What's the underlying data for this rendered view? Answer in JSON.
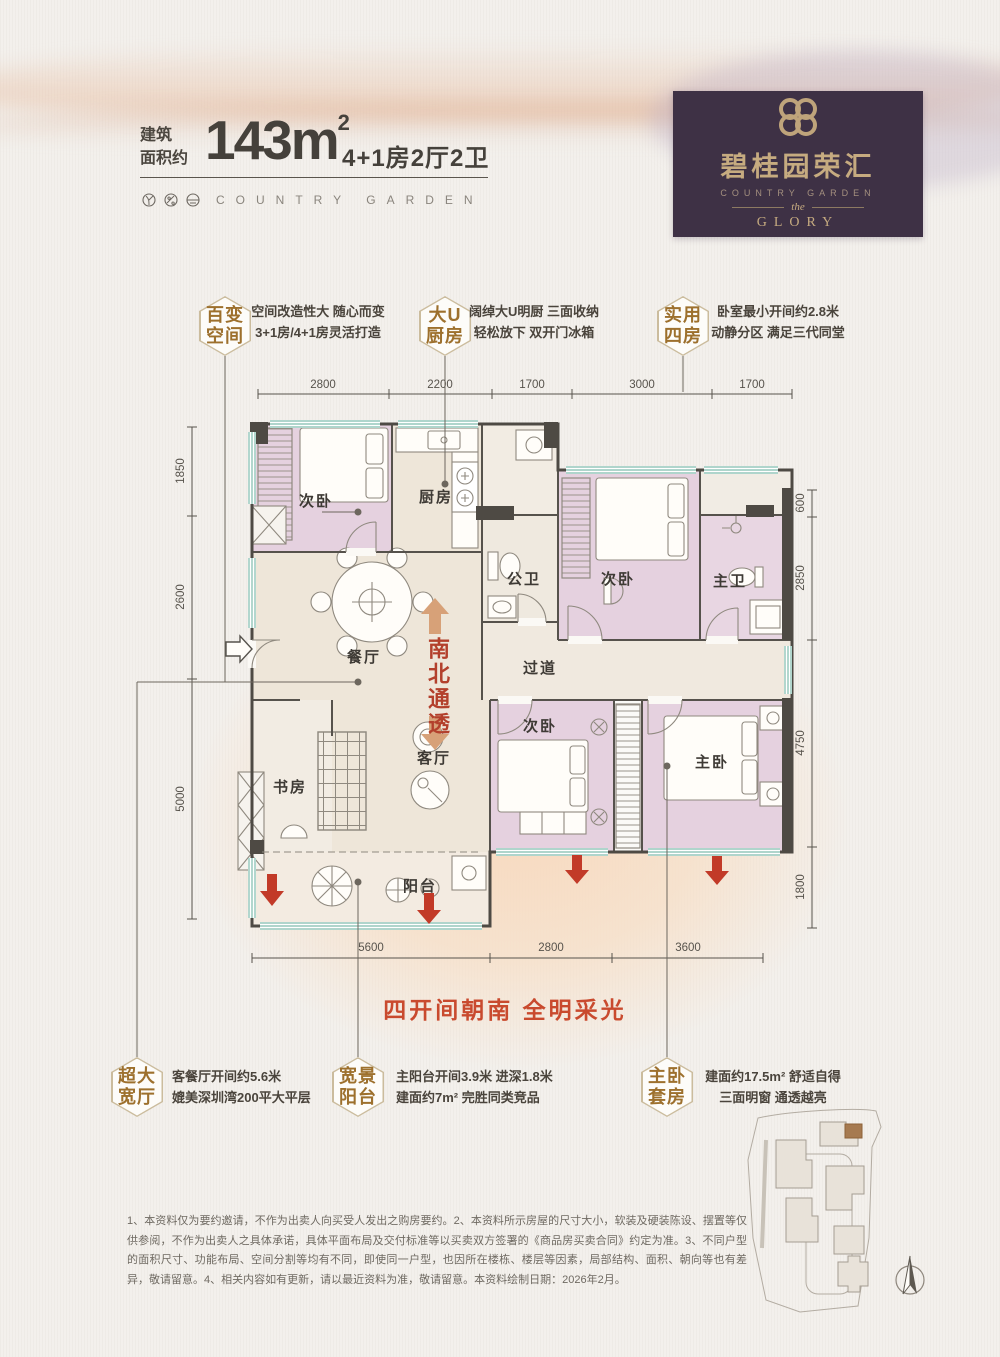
{
  "header": {
    "area_prefix_line1": "建筑",
    "area_prefix_line2": "面积约",
    "area_value": "143m",
    "area_sup": "2",
    "layout": "4+1房2厅2卫",
    "brand_en": "COUNTRY GARDEN"
  },
  "logo": {
    "brand_cn": "碧桂园荣汇",
    "brand_en": "COUNTRY GARDEN",
    "the_label": "the",
    "glory_label": "GLORY"
  },
  "features_top": [
    {
      "badge_line1": "百变",
      "badge_line2": "空间",
      "desc_line1": "空间改造性大 随心而变",
      "desc_line2": "3+1房/4+1房灵活打造"
    },
    {
      "badge_line1": "大U",
      "badge_line2": "厨房",
      "desc_line1": "阔绰大U明厨 三面收纳",
      "desc_line2": "轻松放下 双开门冰箱"
    },
    {
      "badge_line1": "实用",
      "badge_line2": "四房",
      "desc_line1": "卧室最小开间约2.8米",
      "desc_line2": "动静分区 满足三代同堂"
    }
  ],
  "features_bottom": [
    {
      "badge_line1": "超大",
      "badge_line2": "宽厅",
      "desc_line1": "客餐厅开间约5.6米",
      "desc_line2": "媲美深圳湾200平大平层"
    },
    {
      "badge_line1": "宽景",
      "badge_line2": "阳台",
      "desc_line1": "主阳台开间3.9米 进深1.8米",
      "desc_line2": "建面约7m² 完胜同类竞品"
    },
    {
      "badge_line1": "主卧",
      "badge_line2": "套房",
      "desc_line1": "建面约17.5m² 舒适自得",
      "desc_line2": "三面明窗 通透越亮"
    }
  ],
  "plan": {
    "ns_text": "南北通透",
    "rooms": {
      "bedroom_top_left": "次卧",
      "kitchen": "厨房",
      "bath_public": "公卫",
      "bedroom_top_right": "次卧",
      "bath_master": "主卫",
      "hallway": "过道",
      "dining": "餐厅",
      "living": "客厅",
      "study": "书房",
      "bedroom_bottom": "次卧",
      "bedroom_master": "主卧",
      "balcony": "阳台"
    },
    "dims_top": [
      "2800",
      "2200",
      "1700",
      "3000",
      "1700"
    ],
    "dims_left": [
      "1850",
      "2600",
      "5000"
    ],
    "dims_right": [
      "600",
      "2850",
      "4750",
      "1800"
    ],
    "dims_bottom": [
      "5600",
      "2800",
      "3600"
    ]
  },
  "banner": "四开间朝南 全明采光",
  "disclaimer": "1、本资料仅为要约邀请，不作为出卖人向买受人发出之购房要约。2、本资料所示房屋的尺寸大小，软装及硬装陈设、摆置等仅供参阅，不作为出卖人之具体承诺，具体平面布局及交付标准等以买卖双方签署的《商品房买卖合同》约定为准。3、不同户型的面积尺寸、功能布局、空间分割等均有不同，即使同一户型，也因所在楼栋、楼层等因素，局部结构、面积、朝向等也有差异，敬请留意。4、相关内容如有更新，请以最近资料为准，敬请留意。本资料绘制日期：2026年2月。",
  "colors": {
    "brand_purple": "#3e3145",
    "brand_gold": "#c6ab80",
    "accent_red": "#c23a28",
    "arrow_tan": "#d7a178",
    "room_pink": "#e5d1df",
    "room_beige": "#eee6d9",
    "window_teal": "#7fbcae",
    "wall_dark": "#4e4a44"
  }
}
